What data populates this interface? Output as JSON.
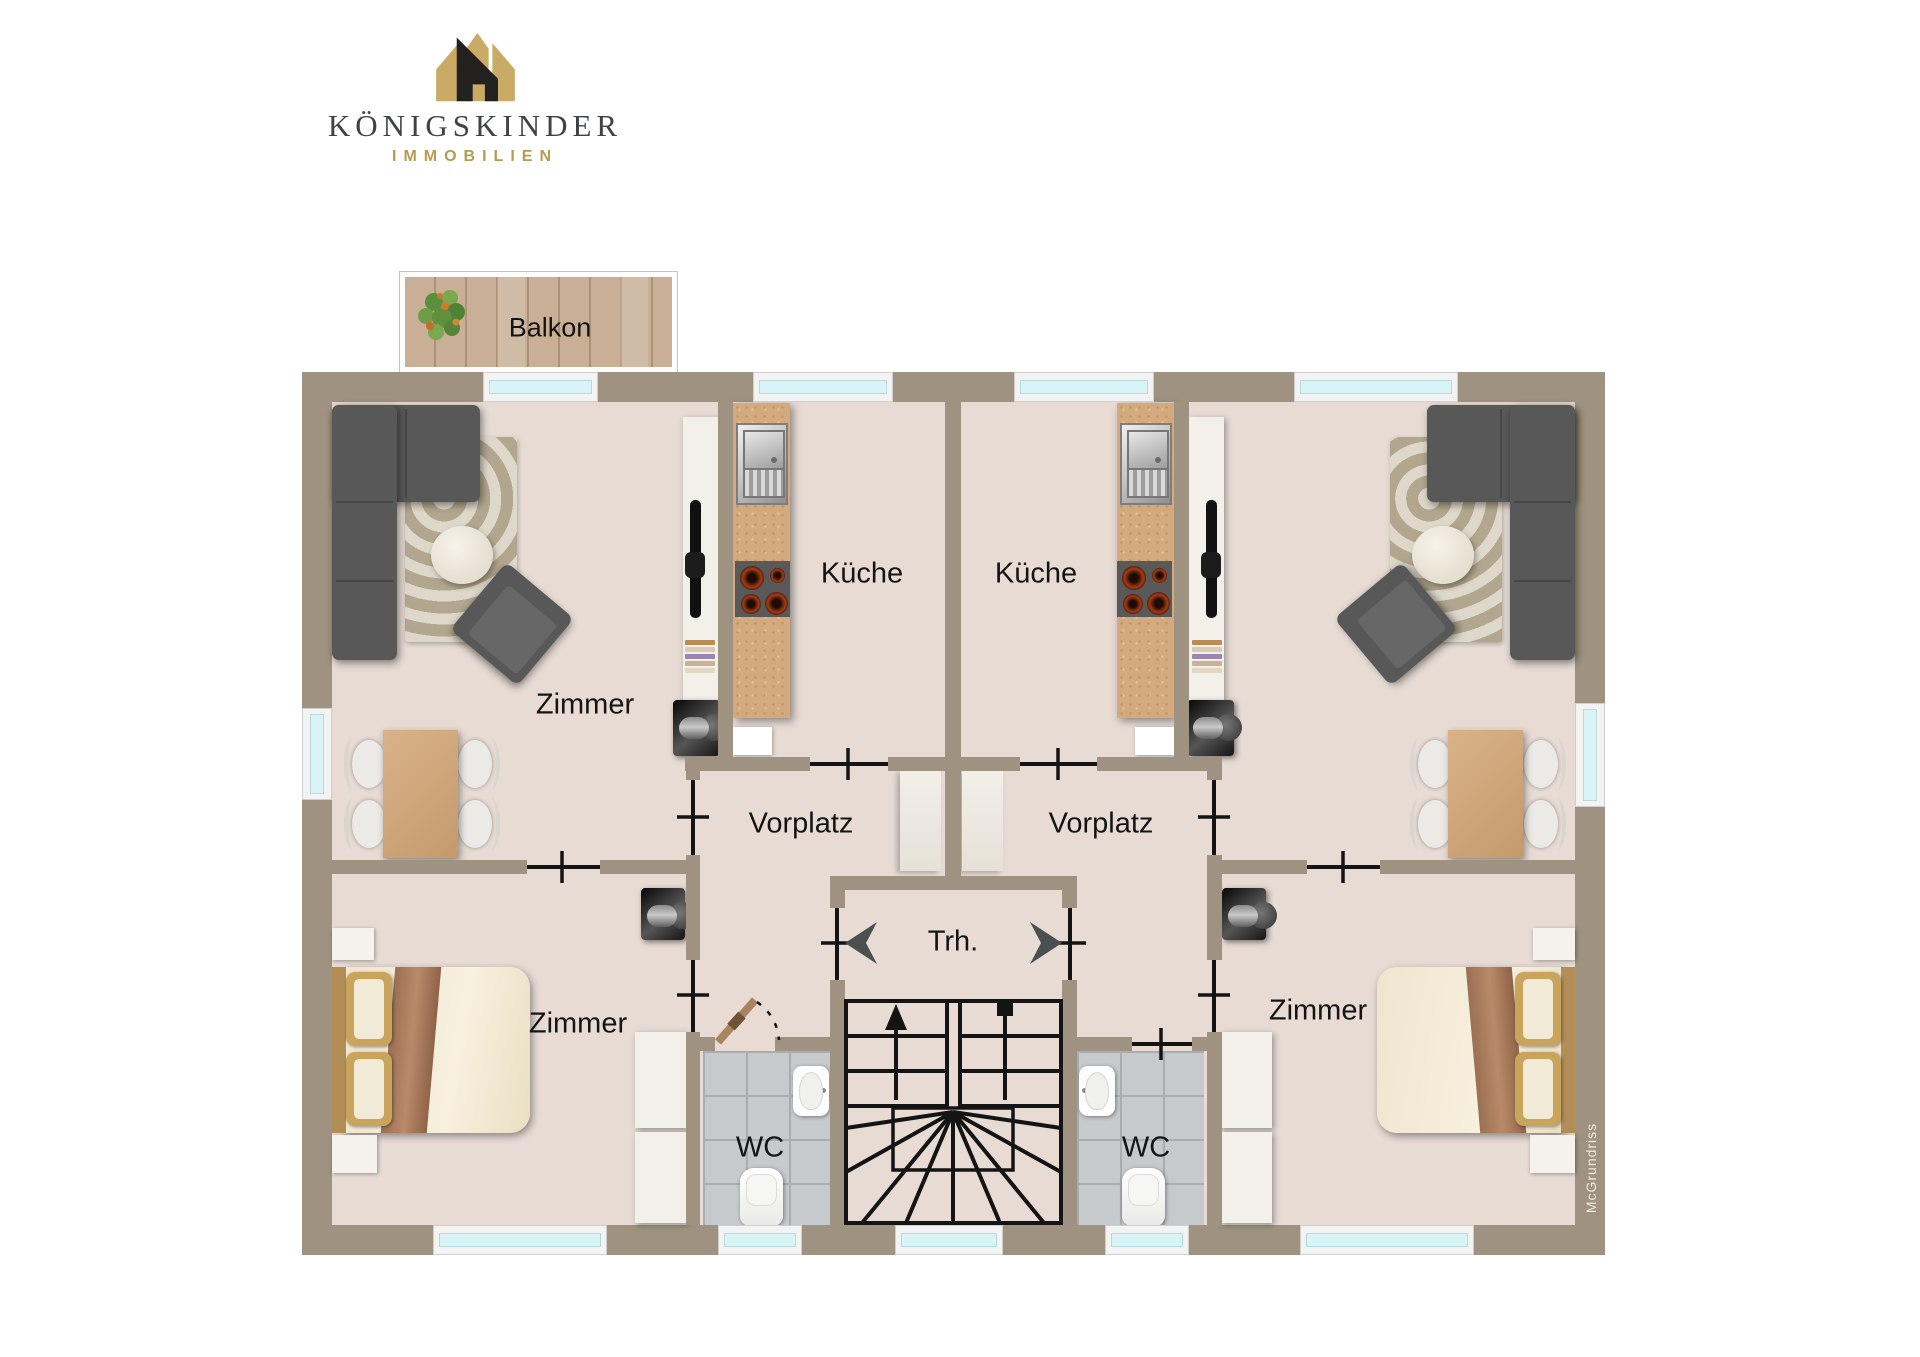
{
  "logo": {
    "brand": "KÖNIGSKINDER",
    "tagline": "IMMOBILIEN"
  },
  "watermark": "McGrundriss",
  "plan": {
    "labels": {
      "balcony": "Balkon",
      "living_left": "Zimmer",
      "kitchen_left": "Küche",
      "kitchen_right": "Küche",
      "hall_left": "Vorplatz",
      "hall_right": "Vorplatz",
      "stairwell": "Trh.",
      "bedroom_left": "Zimmer",
      "bedroom_right": "Zimmer",
      "wc_left": "WC",
      "wc_right": "WC"
    }
  },
  "colors": {
    "wall": "#9f9280",
    "floor": "#e7dbd4",
    "balcony_wood": "#c8af95",
    "kitchen_counter": "#d3aa7d",
    "window_glass": "#d9f4f7",
    "tile": "#c6cacd",
    "sofa": "#585858",
    "rug": "#c4b9a6",
    "bed_blanket": "#a97c5f",
    "gold": "#b99a52",
    "brand_text": "#3e4347",
    "line": "#141414"
  }
}
